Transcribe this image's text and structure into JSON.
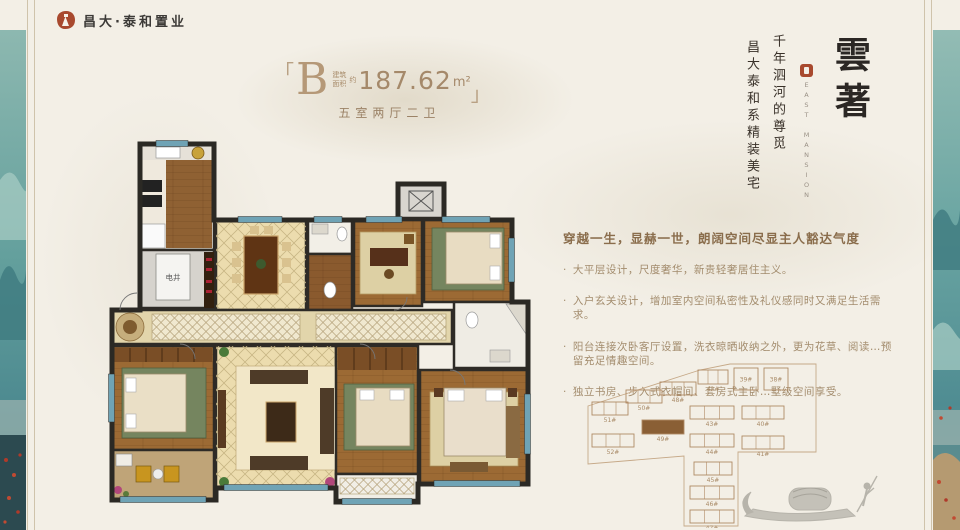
{
  "brand": {
    "logo_text": "昌大·泰和置业"
  },
  "unit": {
    "bracket_left": "「",
    "bracket_right": "」",
    "letter": "B",
    "area_label": "建筑面积",
    "area_approx": "约",
    "area_value": "187.62",
    "area_unit": "m²",
    "layout_text": "五室两厅二卫"
  },
  "headline": {
    "title_vertical": "雲著",
    "seal_en": "EAST MANSION",
    "slogan_col1": "千年泗河的尊觅",
    "slogan_col2": "昌大泰和系精装美宅"
  },
  "marketing": {
    "heading": "穿越一生，显赫一世，朗阔空间尽显主人豁达气度",
    "bullets": [
      "大平层设计，尺度奢华，新贵轻奢居住主义。",
      "入户玄关设计，增加室内空间私密性及礼仪感同时又满足生活需求。",
      "阳台连接次卧客厅设置，洗衣晾晒收纳之外，更为花草、阅读…预留充足情趣空间。",
      "独立书房、步入式衣帽间、套房式主卧…墅级空间享受。"
    ]
  },
  "floorplan": {
    "shaft_label": "电井"
  },
  "siteplan": {
    "highlight_color": "#8a5f35",
    "buildings": [
      {
        "label": "51#",
        "x": 6,
        "y": 42,
        "w": 36,
        "h": 13
      },
      {
        "label": "50#",
        "x": 40,
        "y": 30,
        "w": 36,
        "h": 13
      },
      {
        "label": "48#",
        "x": 74,
        "y": 22,
        "w": 36,
        "h": 13
      },
      {
        "label": "42#",
        "x": 112,
        "y": 10,
        "w": 30,
        "h": 14
      },
      {
        "label": "39#",
        "x": 148,
        "y": 8,
        "w": 24,
        "h": 22,
        "square": true
      },
      {
        "label": "38#",
        "x": 178,
        "y": 8,
        "w": 24,
        "h": 22,
        "square": true
      },
      {
        "label": "49#",
        "x": 56,
        "y": 60,
        "w": 42,
        "h": 14,
        "highlight": true
      },
      {
        "label": "43#",
        "x": 104,
        "y": 46,
        "w": 44,
        "h": 13
      },
      {
        "label": "40#",
        "x": 156,
        "y": 46,
        "w": 42,
        "h": 13
      },
      {
        "label": "52#",
        "x": 6,
        "y": 74,
        "w": 42,
        "h": 13
      },
      {
        "label": "44#",
        "x": 104,
        "y": 74,
        "w": 44,
        "h": 13
      },
      {
        "label": "41#",
        "x": 156,
        "y": 76,
        "w": 42,
        "h": 13
      },
      {
        "label": "45#",
        "x": 108,
        "y": 102,
        "w": 38,
        "h": 13
      },
      {
        "label": "46#",
        "x": 104,
        "y": 126,
        "w": 44,
        "h": 13
      },
      {
        "label": "47#",
        "x": 104,
        "y": 150,
        "w": 44,
        "h": 13
      }
    ]
  },
  "colors": {
    "background": "#f3efe6",
    "accent_red": "#a8492e",
    "title_brown": "#ab8e6b",
    "heading_brown": "#8a6d4c",
    "body_brown": "#a38c6d",
    "wall": "#2b2924",
    "wood_floor": "#9c6a34",
    "tile_floor": "#ecdcae",
    "window_teal": "#6fa3b5",
    "strip_teal": "#64a09d",
    "siteplan_line": "#b08a64"
  }
}
